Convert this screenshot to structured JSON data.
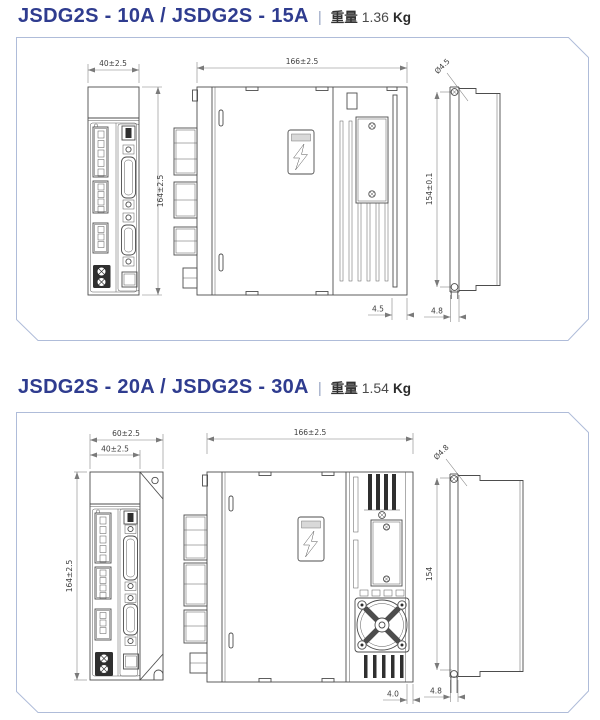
{
  "colors": {
    "title_navy": "#2f3c8f",
    "panel_border": "#afbcd9",
    "object_line": "#4d4d4d",
    "dimension_line": "#7a7a7a"
  },
  "sections": [
    {
      "id": "jsdg2s-10a-15a",
      "title": "JSDG2S - 10A / JSDG2S - 15A",
      "separator": "|",
      "weight": {
        "label": "重量",
        "value": "1.36",
        "unit": "Kg"
      },
      "dimensions": {
        "front_width": "40±2.5",
        "front_height": "164±2.5",
        "side_width": "166±2.5",
        "side_gap": "4.5",
        "rear_hole": "Ø4.5",
        "rear_height": "154±0.1",
        "rear_tab": "4.8"
      }
    },
    {
      "id": "jsdg2s-20a-30a",
      "title": "JSDG2S - 20A / JSDG2S - 30A",
      "separator": "|",
      "weight": {
        "label": "重量",
        "value": "1.54",
        "unit": "Kg"
      },
      "dimensions": {
        "front_outer_width": "60±2.5",
        "front_width": "40±2.5",
        "front_height": "164±2.5",
        "side_width": "166±2.5",
        "side_gap": "4.0",
        "rear_hole": "Ø4.8",
        "rear_height": "154",
        "rear_tab": "4.8"
      }
    }
  ]
}
